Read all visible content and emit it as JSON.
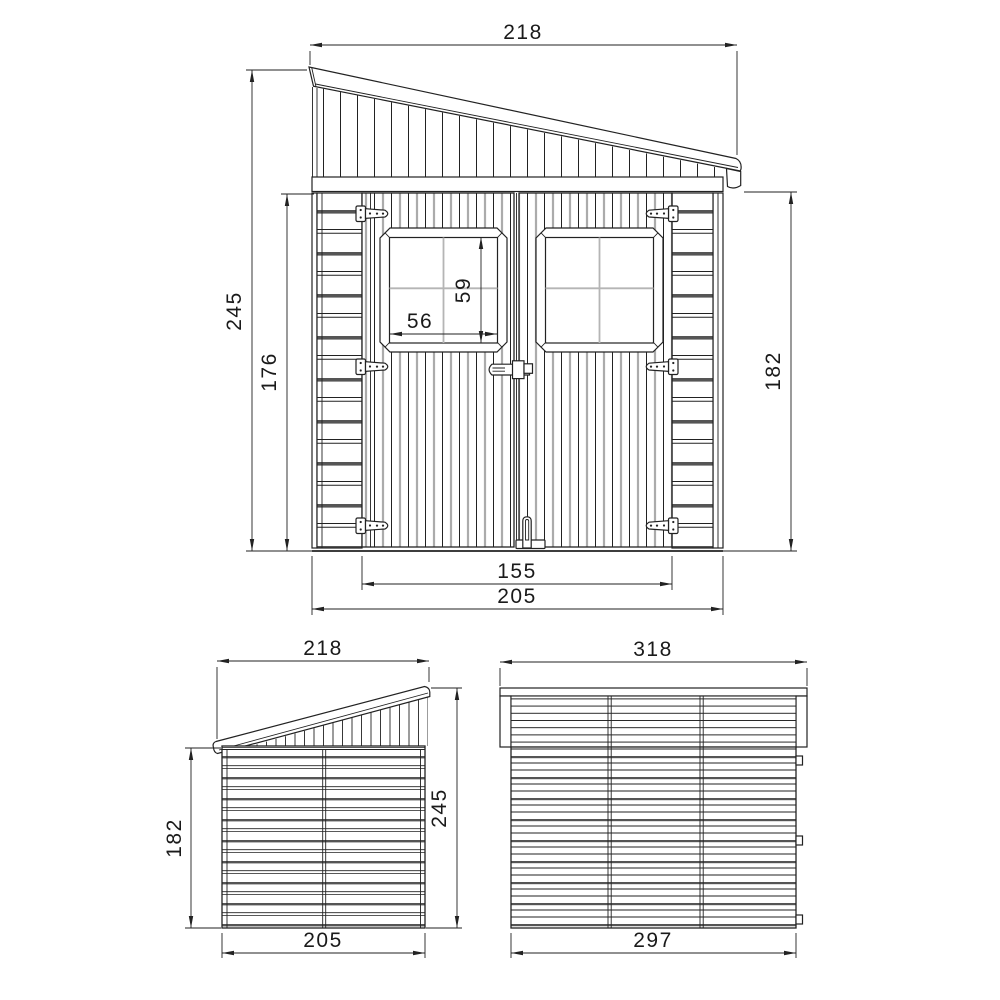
{
  "views": {
    "front": {
      "dims": {
        "roof_width": "218",
        "total_height": "245",
        "opening_height": "176",
        "window_height": "59",
        "window_width": "56",
        "eave_height": "182",
        "door_span": "155",
        "base_width": "205"
      }
    },
    "side": {
      "dims": {
        "roof_depth": "218",
        "low_height": "182",
        "high_height": "245",
        "base_depth": "205"
      }
    },
    "rear": {
      "dims": {
        "roof_length": "318",
        "base_length": "297"
      }
    },
    "colors": {
      "line": "#222222",
      "background": "#ffffff",
      "groove": "#555555",
      "mullion": "#b5b5b5"
    }
  }
}
